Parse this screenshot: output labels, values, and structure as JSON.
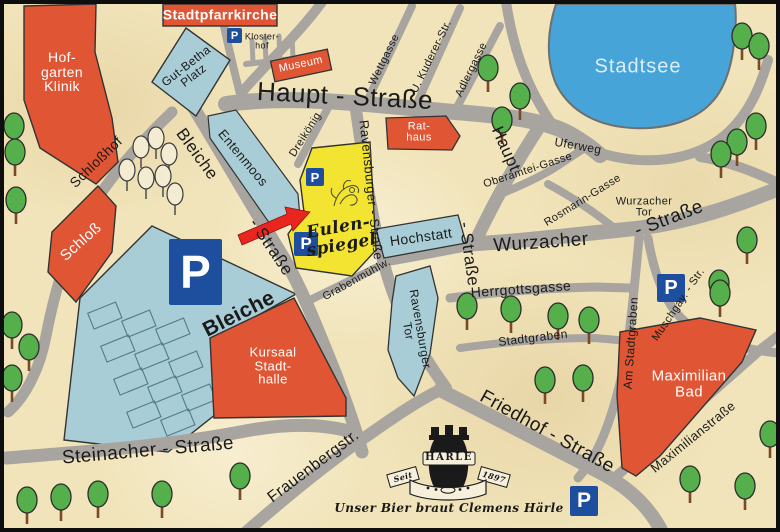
{
  "colors": {
    "parchment": "#f1e4ba",
    "road_gray": "#a8a5a0",
    "water_blue": "#46a4d8",
    "area_blue": "#a9cdd6",
    "building_red": "#e05634",
    "highlight_yellow": "#f2e431",
    "parking_blue": "#1d4f9e",
    "tree_green": "#55b04c",
    "arrow_red": "#e8251f"
  },
  "labels": {
    "stadtpfarrkirche": "Stadtpfarrkirche",
    "hofgarten_klinik": "Hof-\ngarten\nKlinik",
    "klosterhof": "Kloster-\nhof",
    "gut_betha_platz": "Gut-Betha\nPlatz",
    "museum": "Museum",
    "haupt_strasse_h": "Haupt  -  Straße",
    "haupt_v": "Haupt",
    "strasse_suffix": "-  Straße",
    "wettgasse": "Wettgasse",
    "kuderer_str": "U. Kuderer-Str.",
    "adlergasse": "Adlergasse",
    "stadtsee": "Stadtsee",
    "uferweg": "Uferweg",
    "schlosshof": "Schloßhof",
    "schloss": "Schloß",
    "bleiche_street": "Bleiche",
    "entenmoos": "Entenmoos",
    "dreikoenig": "Dreikönig",
    "ravensburger_strasse": "Ravensburger - Straße",
    "rathaus": "Rat-\nhaus",
    "hochstatt": "Hochstatt",
    "oberamtei_gasse": "Oberamtei-Gasse",
    "rosmarin_gasse": "Rosmarin-Gasse",
    "wurzacher_tor": "Wurzacher\nTor",
    "wurzacher_street": "Wurzacher",
    "eulenspiegel": "Eulen-\nspiegel",
    "bleiche_area": "Bleiche",
    "kursaal": "Kursaal\nStadt-\nhalle",
    "herrgottsgasse": "Herrgottsgasse",
    "stadtgraben": "Stadtgraben",
    "am_stadtgraben": "Am  Stadtgraben",
    "muschgay_str": "Muschgay. - Str.",
    "ravensburger_tor": "Ravensburger\nTor",
    "grabenmuehlweg": "Grabenmühlw.",
    "steinacher_strasse": "Steinacher  -  Straße",
    "frauenbergstr": "Frauenbergstr.",
    "friedhof_strasse": "Friedhof  -  Straße",
    "maximilian_bad": "Maximilian\nBad",
    "maximilianstrasse": "Maximilianstraße",
    "parking_symbol": "P"
  },
  "logo": {
    "name": "HÄRLE",
    "since": "Seit",
    "year": "1897",
    "slogan": "Unser Bier braut Clemens Härle"
  }
}
